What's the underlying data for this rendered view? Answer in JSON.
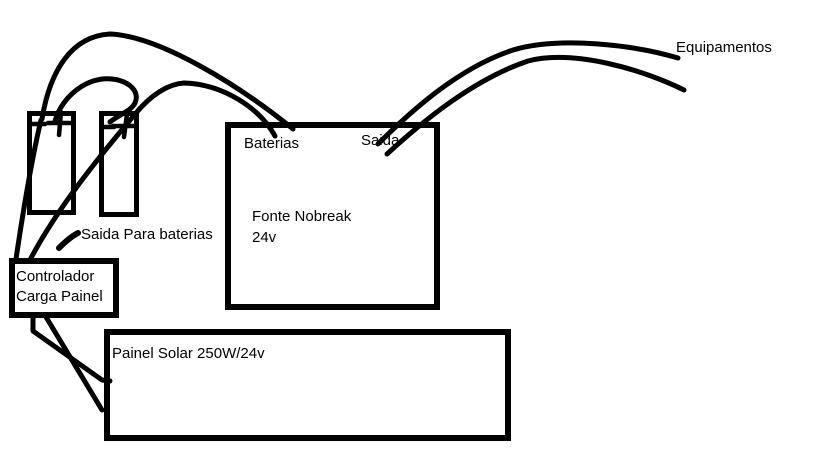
{
  "diagram": {
    "background": "#ffffff",
    "ink": "#000000",
    "title_implicit": "Solar nobreak wiring sketch"
  },
  "labels": {
    "equipamentos": "Equipamentos",
    "baterias_port": "Baterias",
    "saida_port": "Saida",
    "fonte_line1": "Fonte Nobreak",
    "fonte_line2": "24v",
    "controlador_line1": "Controlador",
    "controlador_line2": "Carga Painel",
    "saida_para_baterias": "Saida Para baterias",
    "painel_solar": "Painel Solar 250W/24v"
  },
  "components": {
    "battery1": {
      "type": "battery",
      "terminals": [
        "-",
        "+"
      ]
    },
    "battery2": {
      "type": "battery",
      "terminals": [
        "-",
        "+"
      ]
    },
    "fonte_nobreak": {
      "name": "Fonte Nobreak",
      "voltage": "24v",
      "ports": [
        "Baterias",
        "Saida"
      ]
    },
    "controlador": {
      "name": "Controlador Carga Painel"
    },
    "painel_solar": {
      "name": "Painel Solar 250W/24v"
    }
  },
  "connections": [
    {
      "from": "controlador",
      "to": "battery1"
    },
    {
      "from": "battery1",
      "to": "fonte_nobreak.Baterias"
    },
    {
      "from": "battery1",
      "to": "battery2"
    },
    {
      "from": "controlador",
      "to": "battery2",
      "continues_to": "fonte_nobreak.Baterias"
    },
    {
      "from": "fonte_nobreak.Saida",
      "to": "equipamentos",
      "wires": 2
    },
    {
      "from": "controlador",
      "to": "painel_solar",
      "wires": 2
    }
  ]
}
